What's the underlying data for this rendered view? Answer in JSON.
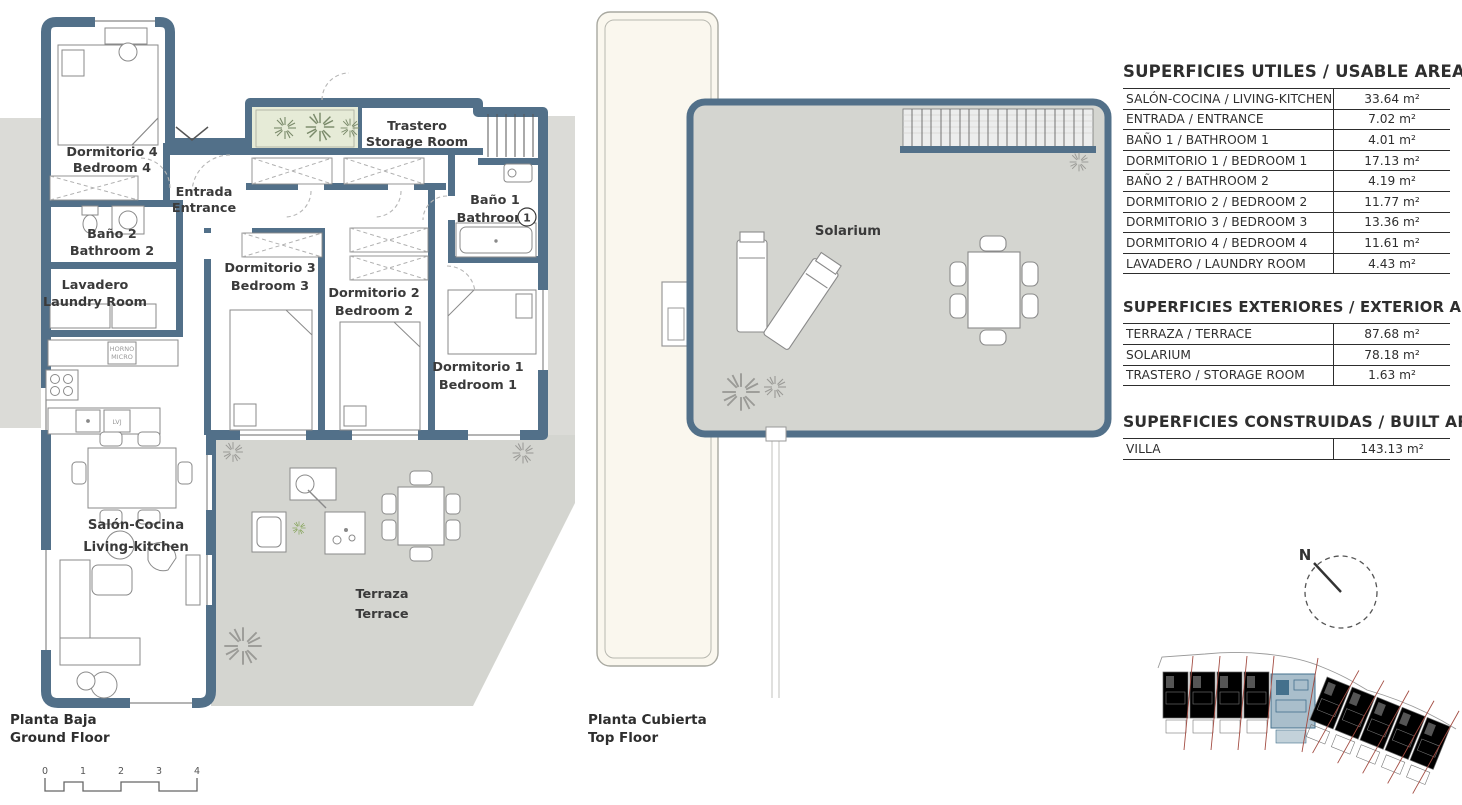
{
  "gf": {
    "bedroom4_es": "Dormitorio 4",
    "bedroom4_en": "Bedroom 4",
    "entrance_es": "Entrada",
    "entrance_en": "Entrance",
    "bath2_es": "Baño 2",
    "bath2_en": "Bathroom 2",
    "laundry_es": "Lavadero",
    "laundry_en": "Laundry Room",
    "storage_es": "Trastero",
    "storage_en": "Storage Room",
    "bath1_es": "Baño 1",
    "bath1_en": "Bathroom",
    "bath1_num": "1",
    "bedroom3_es": "Dormitorio 3",
    "bedroom3_en": "Bedroom 3",
    "bedroom2_es": "Dormitorio 2",
    "bedroom2_en": "Bedroom 2",
    "bedroom1_es": "Dormitorio 1",
    "bedroom1_en": "Bedroom 1",
    "living_es": "Salón-Cocina",
    "living_en": "Living-kitchen",
    "terrace_es": "Terraza",
    "terrace_en": "Terrace",
    "oven": "HORNO",
    "micro": "MICRO",
    "dishwasher": "LVJ",
    "floor_es": "Planta Baja",
    "floor_en": "Ground Floor"
  },
  "tf": {
    "solarium": "Solarium",
    "floor_es": "Planta Cubierta",
    "floor_en": "Top Floor"
  },
  "compass_n": "N",
  "scale": [
    "0",
    "1",
    "2",
    "3",
    "4"
  ],
  "tables": {
    "usable": {
      "title": "SUPERFICIES UTILES / USABLE AREAS",
      "rows": [
        {
          "label": "SALÓN-COCINA / LIVING-KITCHEN",
          "value": "33.64 m²"
        },
        {
          "label": "ENTRADA / ENTRANCE",
          "value": "7.02 m²"
        },
        {
          "label": "BAÑO 1 / BATHROOM 1",
          "value": "4.01 m²"
        },
        {
          "label": "DORMITORIO 1 / BEDROOM 1",
          "value": "17.13 m²"
        },
        {
          "label": "BAÑO 2 / BATHROOM 2",
          "value": "4.19 m²"
        },
        {
          "label": "DORMITORIO 2 / BEDROOM 2",
          "value": "11.77 m²"
        },
        {
          "label": "DORMITORIO 3 / BEDROOM 3",
          "value": "13.36 m²"
        },
        {
          "label": "DORMITORIO 4 / BEDROOM 4",
          "value": "11.61 m²"
        },
        {
          "label": "LAVADERO / LAUNDRY ROOM",
          "value": "4.43 m²"
        }
      ]
    },
    "exterior": {
      "title": "SUPERFICIES EXTERIORES / EXTERIOR AREAS",
      "rows": [
        {
          "label": "TERRAZA / TERRACE",
          "value": "87.68 m²"
        },
        {
          "label": "SOLARIUM",
          "value": "78.18 m²"
        },
        {
          "label": "TRASTERO / STORAGE ROOM",
          "value": "1.63 m²"
        }
      ]
    },
    "built": {
      "title": "SUPERFICIES CONSTRUIDAS / BUILT AREAS",
      "rows": [
        {
          "label": "VILLA",
          "value": "143.13 m²"
        }
      ]
    }
  },
  "colors": {
    "wall": "#527089",
    "terrace": "#d4d5d0",
    "background_patch": "#dbdbd7",
    "planter": "#e6ebd7",
    "cream_strip": "#faf7ee",
    "site_highlight": "#a9becb",
    "site_red_line": "#a34c42"
  }
}
